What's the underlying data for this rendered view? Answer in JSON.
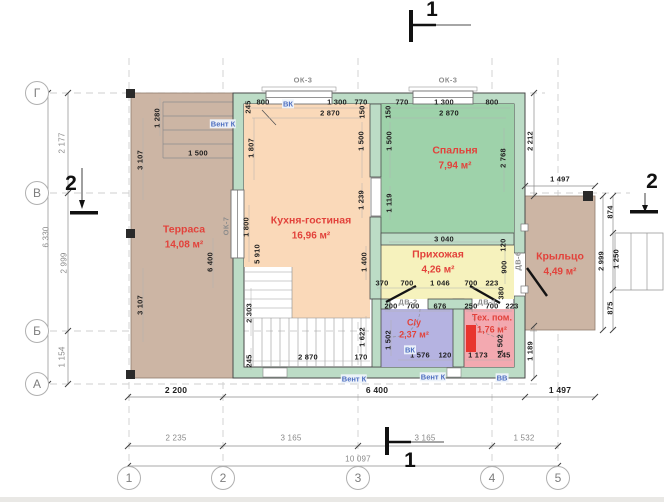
{
  "drawing_title": "План этажа",
  "colors": {
    "wall_fill": "#bcdcc6",
    "terrace_fill": "#ccb5a4",
    "kitchen_fill": "#fad9b9",
    "bedroom_fill": "#9ed2aa",
    "hall_fill": "#f6f2bd",
    "bathroom_fill": "#b5b3e1",
    "tech_fill": "#f3a9b0",
    "boiler_red": "#e8352e",
    "room_label_red": "#e2423b",
    "vent_blue": "#4e6fc0"
  },
  "rooms": [
    {
      "id": "terrace",
      "name": "Терраса",
      "area": "14,08 м²"
    },
    {
      "id": "kitchen",
      "name": "Кухня-гостиная",
      "area": "16,96 м²"
    },
    {
      "id": "bedroom",
      "name": "Спальня",
      "area": "7,94 м²"
    },
    {
      "id": "hall",
      "name": "Прихожая",
      "area": "4,26 м²"
    },
    {
      "id": "bathroom",
      "name": "С/у",
      "area": "2,37 м²"
    },
    {
      "id": "tech",
      "name": "Тех. пом.",
      "area": "1,76 м²"
    },
    {
      "id": "porch",
      "name": "Крыльцо",
      "area": "4,49 м²"
    }
  ],
  "axes": {
    "bottom": [
      {
        "label": "1",
        "x": 129,
        "y": 478
      },
      {
        "label": "2",
        "x": 223,
        "y": 478
      },
      {
        "label": "3",
        "x": 358,
        "y": 478
      },
      {
        "label": "4",
        "x": 492,
        "y": 478
      },
      {
        "label": "5",
        "x": 558,
        "y": 478
      }
    ],
    "left": [
      {
        "label": "Г",
        "x": 37,
        "y": 93
      },
      {
        "label": "В",
        "x": 37,
        "y": 193
      },
      {
        "label": "Б",
        "x": 37,
        "y": 331
      },
      {
        "label": "А",
        "x": 37,
        "y": 384
      }
    ]
  },
  "section_markers": [
    {
      "label": "1",
      "x": 432,
      "y": 10
    },
    {
      "label": "1",
      "x": 410,
      "y": 461
    },
    {
      "label": "2",
      "x": 71,
      "y": 184
    },
    {
      "label": "2",
      "x": 652,
      "y": 182
    }
  ],
  "dim_labels": [
    {
      "t": "2 177",
      "x": 62,
      "y": 143,
      "r": 1,
      "c": "g"
    },
    {
      "t": "6 330",
      "x": 46,
      "y": 237,
      "r": 1,
      "c": "g"
    },
    {
      "t": "2 999",
      "x": 64,
      "y": 263,
      "r": 1,
      "c": "g"
    },
    {
      "t": "1 154",
      "x": 62,
      "y": 357,
      "r": 1,
      "c": "g"
    },
    {
      "t": "2 235",
      "x": 176,
      "y": 438,
      "c": "g"
    },
    {
      "t": "3 165",
      "x": 291,
      "y": 438,
      "c": "g"
    },
    {
      "t": "3 165",
      "x": 425,
      "y": 438,
      "c": "g"
    },
    {
      "t": "1 532",
      "x": 524,
      "y": 438,
      "c": "g"
    },
    {
      "t": "10 097",
      "x": 358,
      "y": 459,
      "c": "g"
    },
    {
      "t": "2 200",
      "x": 176,
      "y": 390,
      "c": "b"
    },
    {
      "t": "6 400",
      "x": 377,
      "y": 390,
      "c": "b"
    },
    {
      "t": "1 497",
      "x": 560,
      "y": 390,
      "c": "b"
    },
    {
      "t": "1 497",
      "x": 560,
      "y": 179
    },
    {
      "t": "2 212",
      "x": 530,
      "y": 141,
      "r": 1
    },
    {
      "t": "1 189",
      "x": 530,
      "y": 351,
      "r": 1
    },
    {
      "t": "874",
      "x": 610,
      "y": 212,
      "r": 1
    },
    {
      "t": "1 250",
      "x": 616,
      "y": 259,
      "r": 1
    },
    {
      "t": "875",
      "x": 610,
      "y": 308,
      "r": 1
    },
    {
      "t": "2 999",
      "x": 601,
      "y": 261,
      "r": 1
    },
    {
      "t": "3 107",
      "x": 140,
      "y": 160,
      "r": 1
    },
    {
      "t": "3 107",
      "x": 140,
      "y": 305,
      "r": 1
    },
    {
      "t": "1 280",
      "x": 157,
      "y": 118,
      "r": 1
    },
    {
      "t": "1 500",
      "x": 198,
      "y": 153
    },
    {
      "t": "6 400",
      "x": 210,
      "y": 262,
      "r": 1
    },
    {
      "t": "1 800",
      "x": 246,
      "y": 227,
      "r": 1
    },
    {
      "t": "5 910",
      "x": 257,
      "y": 254,
      "r": 1
    },
    {
      "t": "245",
      "x": 248,
      "y": 107,
      "r": 1
    },
    {
      "t": "800",
      "x": 263,
      "y": 102
    },
    {
      "t": "1 300",
      "x": 337,
      "y": 102
    },
    {
      "t": "770",
      "x": 361,
      "y": 102
    },
    {
      "t": "2 870",
      "x": 330,
      "y": 113
    },
    {
      "t": "150",
      "x": 362,
      "y": 112,
      "r": 1
    },
    {
      "t": "1 807",
      "x": 251,
      "y": 148,
      "r": 1
    },
    {
      "t": "1 500",
      "x": 361,
      "y": 141,
      "r": 1
    },
    {
      "t": "1 239",
      "x": 361,
      "y": 200,
      "r": 1
    },
    {
      "t": "1 400",
      "x": 364,
      "y": 262,
      "r": 1
    },
    {
      "t": "150",
      "x": 388,
      "y": 112,
      "r": 1
    },
    {
      "t": "770",
      "x": 402,
      "y": 102
    },
    {
      "t": "1 300",
      "x": 444,
      "y": 102
    },
    {
      "t": "800",
      "x": 492,
      "y": 102
    },
    {
      "t": "2 870",
      "x": 449,
      "y": 113
    },
    {
      "t": "1 500",
      "x": 389,
      "y": 141,
      "r": 1
    },
    {
      "t": "1 119",
      "x": 389,
      "y": 203,
      "r": 1
    },
    {
      "t": "2 768",
      "x": 503,
      "y": 158,
      "r": 1
    },
    {
      "t": "3 040",
      "x": 444,
      "y": 239
    },
    {
      "t": "120",
      "x": 503,
      "y": 245,
      "r": 1
    },
    {
      "t": "900",
      "x": 504,
      "y": 267,
      "r": 1
    },
    {
      "t": "380",
      "x": 501,
      "y": 293,
      "r": 1
    },
    {
      "t": "370",
      "x": 382,
      "y": 283
    },
    {
      "t": "700",
      "x": 407,
      "y": 283
    },
    {
      "t": "1 046",
      "x": 440,
      "y": 283
    },
    {
      "t": "700",
      "x": 471,
      "y": 283
    },
    {
      "t": "223",
      "x": 492,
      "y": 283
    },
    {
      "t": "200",
      "x": 391,
      "y": 306
    },
    {
      "t": "700",
      "x": 413,
      "y": 306
    },
    {
      "t": "676",
      "x": 440,
      "y": 306
    },
    {
      "t": "1 502",
      "x": 388,
      "y": 340,
      "r": 1
    },
    {
      "t": "1 576",
      "x": 420,
      "y": 355
    },
    {
      "t": "120",
      "x": 445,
      "y": 355
    },
    {
      "t": "250",
      "x": 471,
      "y": 306
    },
    {
      "t": "700",
      "x": 492,
      "y": 306
    },
    {
      "t": "223",
      "x": 512,
      "y": 306
    },
    {
      "t": "1 502",
      "x": 500,
      "y": 344,
      "r": 1
    },
    {
      "t": "1 173",
      "x": 478,
      "y": 355
    },
    {
      "t": "245",
      "x": 504,
      "y": 355
    },
    {
      "t": "2 303",
      "x": 249,
      "y": 313,
      "r": 1
    },
    {
      "t": "245",
      "x": 249,
      "y": 361,
      "r": 1
    },
    {
      "t": "2 870",
      "x": 308,
      "y": 357
    },
    {
      "t": "170",
      "x": 361,
      "y": 357
    },
    {
      "t": "1 622",
      "x": 362,
      "y": 337,
      "r": 1
    }
  ],
  "opening_labels": [
    {
      "t": "ОК-3",
      "x": 303,
      "y": 80
    },
    {
      "t": "ОК-3",
      "x": 448,
      "y": 80
    },
    {
      "t": "ОК-7",
      "x": 226,
      "y": 226,
      "r": 1
    },
    {
      "t": "ДВ-2",
      "x": 408,
      "y": 302
    },
    {
      "t": "ДВ-1",
      "x": 487,
      "y": 302
    },
    {
      "t": "ДВ-6",
      "x": 518,
      "y": 261,
      "r": 1
    }
  ],
  "vent_labels": [
    {
      "t": "ВК",
      "x": 288,
      "y": 104
    },
    {
      "t": "Вент К",
      "x": 223,
      "y": 124
    },
    {
      "t": "ВК",
      "x": 410,
      "y": 350
    },
    {
      "t": "Вент К",
      "x": 354,
      "y": 379
    },
    {
      "t": "Вент К",
      "x": 433,
      "y": 377
    },
    {
      "t": "ВВ",
      "x": 502,
      "y": 378
    }
  ]
}
